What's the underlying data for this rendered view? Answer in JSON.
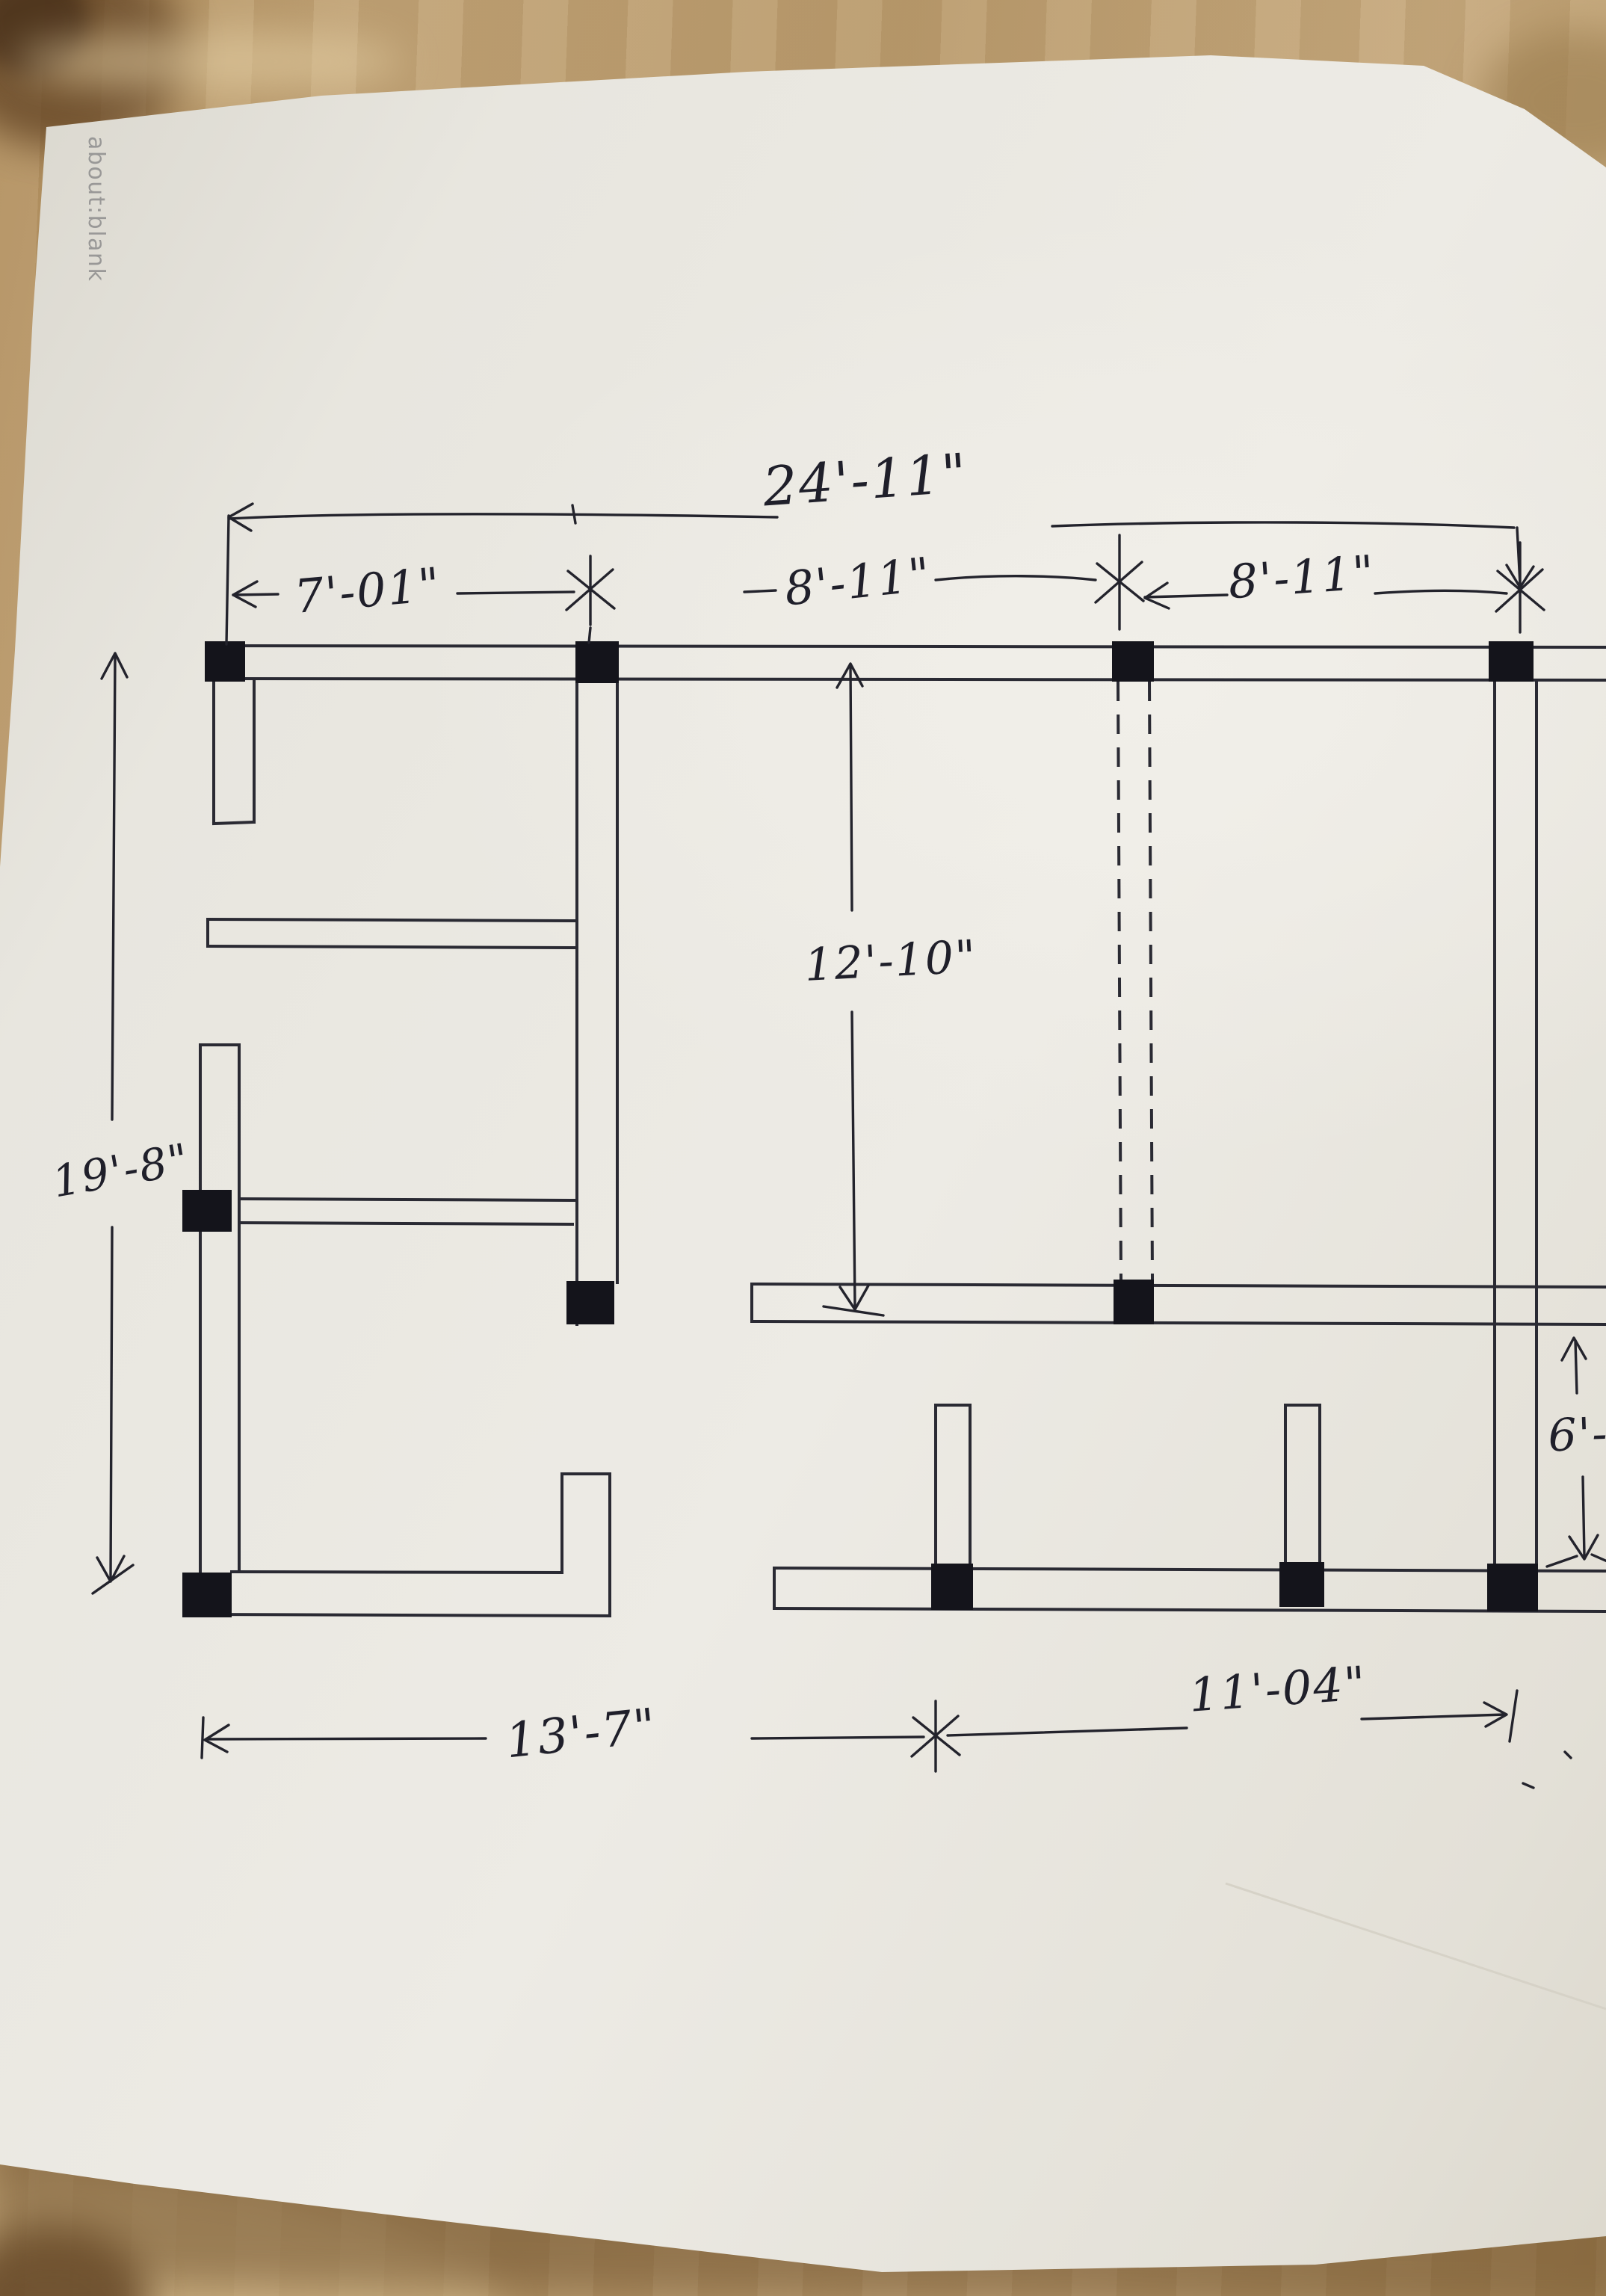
{
  "watermark": "about:blank",
  "drawing": {
    "type": "hand-drawn floor plan column layout sketch",
    "dimension_labels": {
      "total_top_width": "24'-11\"",
      "top_segment_1": "7'-01\"",
      "top_segment_2": "8'-11\"",
      "top_segment_3": "8'-11\"",
      "middle_room_depth": "12'-10\"",
      "left_total_height": "19'-8\"",
      "bottom_left_width": "13'-7\"",
      "bottom_right_width": "11'-04\"",
      "right_lower_depth": "6'-"
    }
  }
}
